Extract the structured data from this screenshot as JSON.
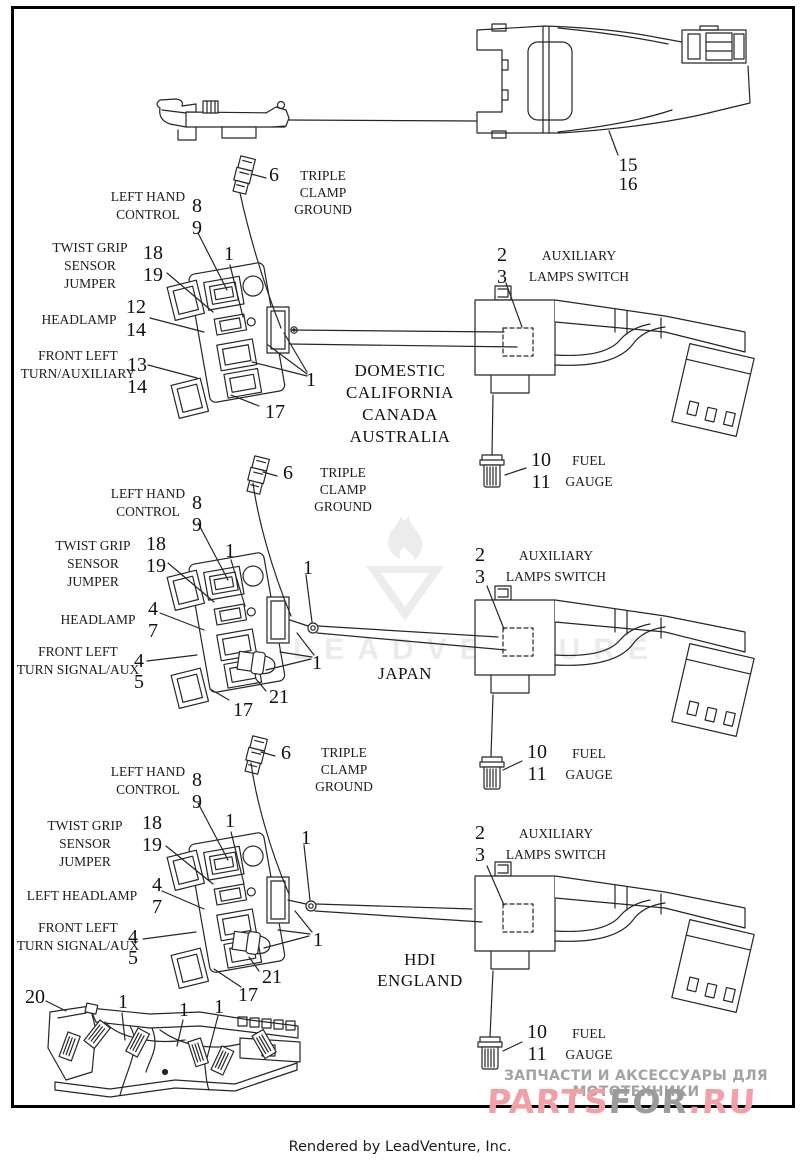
{
  "footer": {
    "credit": "Rendered by LeadVenture, Inc."
  },
  "watermarks": {
    "center_text": "LEADVENTURE",
    "ru_tagline": "ЗАПЧАСТИ И АКСЕССУАРЫ ДЛЯ МОТОТЕХНИКИ",
    "logo_parts": "PARTS",
    "logo_for": "FOR",
    "logo_ru": ".RU"
  },
  "colors": {
    "ink": "#262626",
    "watermark_gray": "#ececec",
    "logo_pink": "#f2a0a7",
    "logo_gray": "#9b9b9b"
  },
  "top_assembly": {
    "callouts": {
      "harness": "15\n16"
    }
  },
  "sections": [
    {
      "region": "DOMESTIC\nCALIFORNIA\nCANADA\nAUSTRALIA",
      "labels": {
        "ground": "TRIPLE\nCLAMP\nGROUND",
        "control": "LEFT HAND\nCONTROL",
        "jumper": "TWIST GRIP\nSENSOR\nJUMPER",
        "headlamp": "HEADLAMP",
        "turn": "FRONT LEFT\nTURN/AUXILIARY",
        "aux_switch": "AUXILIARY\nLAMPS SWITCH",
        "fuel": "FUEL\nGAUGE"
      },
      "callouts": {
        "ground": "6",
        "control": "8\n9",
        "jumper": "18\n19",
        "headlamp": "12\n14",
        "turn": "13\n14",
        "bracket": "17",
        "aux_switch": "2\n3",
        "fuel": "10\n11",
        "pin_top": "1",
        "pin_right": "1"
      }
    },
    {
      "region": "JAPAN",
      "labels": {
        "ground": "TRIPLE\nCLAMP\nGROUND",
        "control": "LEFT HAND\nCONTROL",
        "jumper": "TWIST GRIP\nSENSOR\nJUMPER",
        "headlamp": "HEADLAMP",
        "turn": "FRONT LEFT\nTURN SIGNAL/AUX",
        "aux_switch": "AUXILIARY\nLAMPS SWITCH",
        "fuel": "FUEL\nGAUGE"
      },
      "callouts": {
        "ground": "6",
        "control": "8\n9",
        "jumper": "18\n19",
        "headlamp": "4\n7",
        "turn": "4\n5",
        "bracket": "17",
        "boot": "21",
        "aux_switch": "2\n3",
        "fuel": "10\n11",
        "pin_top": "1",
        "pin_right": "1",
        "pin_far": "1"
      }
    },
    {
      "region": "HDI\nENGLAND",
      "labels": {
        "ground": "TRIPLE\nCLAMP\nGROUND",
        "control": "LEFT HAND\nCONTROL",
        "jumper": "TWIST GRIP\nSENSOR\nJUMPER",
        "headlamp": "LEFT HEADLAMP",
        "turn": "FRONT LEFT\nTURN SIGNAL/AUX",
        "aux_switch": "AUXILIARY\nLAMPS SWITCH",
        "fuel": "FUEL\nGAUGE"
      },
      "callouts": {
        "ground": "6",
        "control": "8\n9",
        "jumper": "18\n19",
        "headlamp": "4\n7",
        "turn": "4\n5",
        "bracket": "17",
        "boot": "21",
        "aux_switch": "2\n3",
        "fuel": "10\n11",
        "pin_top": "1",
        "pin_right": "1",
        "pin_far": "1"
      }
    }
  ],
  "bottom_assembly": {
    "callouts": {
      "clip": "20",
      "pin_a": "1",
      "pin_b": "1",
      "pin_c": "1"
    }
  }
}
